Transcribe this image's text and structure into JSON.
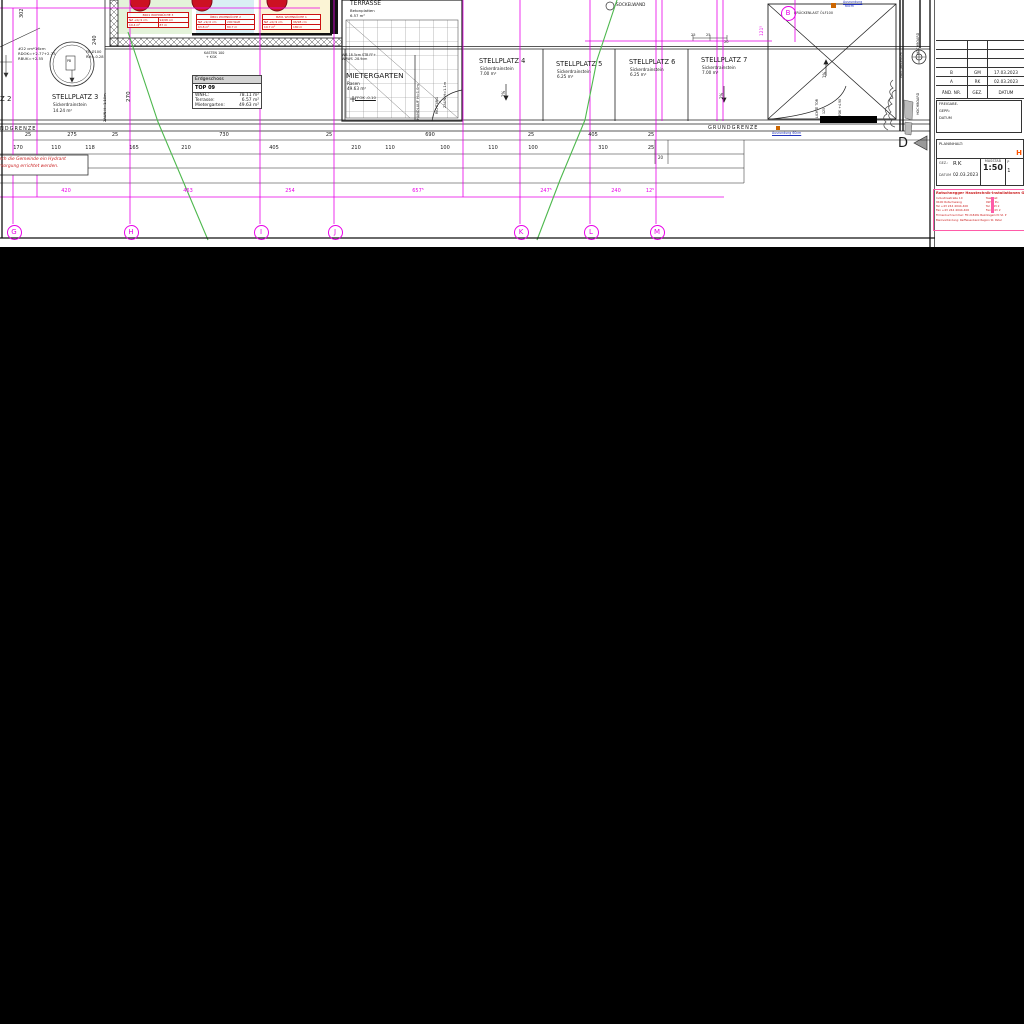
{
  "plan": {
    "colors": {
      "axis_magenta": "#e800e8",
      "contour_green": "#4db84d",
      "tag_red": "#cc1111",
      "note_red": "#cc2222",
      "blue_note": "#2233bb",
      "orange": "#cc6600",
      "room_green": "#e4f3da",
      "room_cyan": "#d9eff4",
      "room_yellow": "#fbf4d5"
    },
    "labels": [
      {
        "n": "stellplatz-2-label",
        "t": "Z 2",
        "x": 0,
        "y": 96,
        "s": 7
      },
      {
        "n": "stellplatz-3-label",
        "t": "STELLPLATZ 3",
        "x": 52,
        "y": 94,
        "s": 6.6
      },
      {
        "n": "stellplatz-3-sub",
        "t": "Sickerdrainstein",
        "x": 53,
        "y": 103,
        "s": 4.2
      },
      {
        "n": "stellplatz-3-area",
        "t": "14.24 m²",
        "x": 53,
        "y": 109,
        "s": 4.2
      },
      {
        "n": "shaft-note-1",
        "t": "#22 cm*16cm",
        "x": 18,
        "y": 47,
        "s": 3.8
      },
      {
        "n": "shaft-note-2",
        "t": "RDOK=+2.77+2.73",
        "x": 18,
        "y": 52,
        "s": 3.8
      },
      {
        "n": "shaft-note-3",
        "t": "RBUK=+2.55",
        "x": 18,
        "y": 57,
        "s": 3.8
      },
      {
        "n": "fb-note-1",
        "t": "FB Ø100",
        "x": 86,
        "y": 51,
        "s": 3.6
      },
      {
        "n": "fb-note-2",
        "t": "RH=-0.28",
        "x": 86,
        "y": 56,
        "s": 3.6
      },
      {
        "n": "dim-302",
        "t": "302",
        "x": 20,
        "y": 18,
        "s": 5,
        "r": 1
      },
      {
        "n": "dim-240",
        "t": "240",
        "x": 93,
        "y": 45,
        "s": 5,
        "r": 1
      },
      {
        "n": "dim-270",
        "t": "270",
        "x": 127,
        "y": 102,
        "s": 5.6,
        "r": 1
      },
      {
        "n": "zaun-left-label",
        "t": "ZAUN H=1.10m",
        "x": 104,
        "y": 122,
        "s": 3.6,
        "r": 1
      },
      {
        "n": "kasten-note-1",
        "t": "KASTEN 100",
        "x": 204,
        "y": 52,
        "s": 3.3
      },
      {
        "n": "kasten-note-2",
        "t": "+ KGK",
        "x": 206,
        "y": 56,
        "s": 3.3
      },
      {
        "n": "wb-note-1",
        "t": "WB 18.5cm STB FF+",
        "x": 342,
        "y": 54,
        "s": 3.3
      },
      {
        "n": "wb-note-2",
        "t": "WRWS -28.9cm",
        "x": 342,
        "y": 58,
        "s": 3.3
      },
      {
        "n": "terrasse-label",
        "t": "TERRASSE",
        "x": 350,
        "y": 1,
        "s": 6
      },
      {
        "n": "terrasse-material",
        "t": "Betonplatten",
        "x": 350,
        "y": 9,
        "s": 3.8
      },
      {
        "n": "terrasse-area",
        "t": "6.57 m²",
        "x": 350,
        "y": 14,
        "s": 3.8
      },
      {
        "n": "mietergarten-label",
        "t": "MIETERGARTEN",
        "x": 346,
        "y": 72,
        "s": 7.4
      },
      {
        "n": "mietergarten-surface",
        "t": "Rasen",
        "x": 347,
        "y": 82,
        "s": 4.2
      },
      {
        "n": "mietergarten-area",
        "t": "49.63 m²",
        "x": 347,
        "y": 87,
        "s": 4.2
      },
      {
        "n": "ffok-note",
        "t": "FFOK -0.10",
        "x": 355,
        "y": 96,
        "s": 3.8,
        "u": true
      },
      {
        "n": "handlauf-label",
        "t": "HANDLAUF H=1.0m",
        "x": 417,
        "y": 120,
        "s": 3.6,
        "r": 1
      },
      {
        "n": "zaun-right-label",
        "t": "ZAUN H=1.1m",
        "x": 444,
        "y": 108,
        "s": 3.6,
        "r": 1
      },
      {
        "n": "richtung-label",
        "t": "RICHTUNG",
        "x": 436,
        "y": 114,
        "s": 3.2,
        "r": 1
      },
      {
        "n": "stellplatz-4-label",
        "t": "STELLPLATZ 4",
        "x": 479,
        "y": 58,
        "s": 6.6
      },
      {
        "n": "stellplatz-4-sub",
        "t": "Sickerdrainstein",
        "x": 480,
        "y": 67,
        "s": 4.2
      },
      {
        "n": "stellplatz-4-area",
        "t": "7.00 m²",
        "x": 480,
        "y": 72,
        "s": 4.2
      },
      {
        "n": "stellplatz-5-label",
        "t": "STELLPLATZ 5",
        "x": 556,
        "y": 61,
        "s": 6.6
      },
      {
        "n": "stellplatz-5-sub",
        "t": "Sickerdrainstein",
        "x": 557,
        "y": 70,
        "s": 4.2
      },
      {
        "n": "stellplatz-5-area",
        "t": "6.25 m²",
        "x": 557,
        "y": 75,
        "s": 4.2
      },
      {
        "n": "stellplatz-6-label",
        "t": "STELLPLATZ 6",
        "x": 629,
        "y": 59,
        "s": 6.6
      },
      {
        "n": "stellplatz-6-sub",
        "t": "Sickerdrainstein",
        "x": 630,
        "y": 68,
        "s": 4.2
      },
      {
        "n": "stellplatz-6-area",
        "t": "6.25 m²",
        "x": 630,
        "y": 73,
        "s": 4.2
      },
      {
        "n": "stellplatz-7-label",
        "t": "STELLPLATZ 7",
        "x": 701,
        "y": 57,
        "s": 6.6
      },
      {
        "n": "stellplatz-7-sub",
        "t": "Sickerdrainstein",
        "x": 702,
        "y": 66,
        "s": 4.2
      },
      {
        "n": "stellplatz-7-area",
        "t": "7.00 m²",
        "x": 702,
        "y": 71,
        "s": 4.2
      },
      {
        "n": "slope-2pct-left",
        "t": "2%",
        "x": 502,
        "y": 97,
        "s": 4,
        "r": 1
      },
      {
        "n": "slope-2pct-right",
        "t": "2%",
        "x": 720,
        "y": 99,
        "s": 4,
        "r": 1
      },
      {
        "n": "sockelwand-label",
        "t": "SOCKELWAND",
        "x": 616,
        "y": 3,
        "s": 4.2
      },
      {
        "n": "dim-121-5",
        "t": "121⁵",
        "x": 761,
        "y": 36,
        "s": 4.4,
        "r": 1,
        "c": "#e800e8"
      },
      {
        "n": "bruckenlast-note",
        "t": "BRÜCKENLAST ÖLF100",
        "x": 794,
        "y": 12,
        "s": 3.4
      },
      {
        "n": "ausrundung-top-1",
        "t": "Ausrundung",
        "x": 843,
        "y": 1,
        "s": 3.2,
        "c": "#2233bb",
        "u": true
      },
      {
        "n": "ausrundung-top-2",
        "t": "60cm",
        "x": 845,
        "y": 5,
        "s": 3.2,
        "c": "#2233bb"
      },
      {
        "n": "slope-1pct",
        "t": "1%",
        "x": 823,
        "y": 78,
        "s": 4,
        "r": 1
      },
      {
        "n": "lichte-tor-label",
        "t": "LICHTE TOR",
        "x": 816,
        "y": 118,
        "s": 3.2,
        "r": 1
      },
      {
        "n": "tor-125",
        "t": "125",
        "x": 823,
        "y": 114,
        "s": 3.2,
        "r": 1
      },
      {
        "n": "ffok-tor",
        "t": "FFOK +4.90",
        "x": 839,
        "y": 118,
        "s": 3.2,
        "r": 1
      },
      {
        "n": "ausrundung-bottom",
        "t": "Ausrundung 60cm",
        "x": 772,
        "y": 132,
        "s": 3.2,
        "c": "#2233bb",
        "u": true
      },
      {
        "n": "grundgrenze-right",
        "t": "GRUNDGRENZE",
        "x": 708,
        "y": 126,
        "s": 5,
        "ls": 1
      },
      {
        "n": "grundgrenze-left",
        "t": "NDGRENZE",
        "x": 0,
        "y": 127,
        "s": 5,
        "ls": 1
      },
      {
        "n": "hydrant-note-1",
        "t": "durch die Gemeinde ein Hydrant",
        "x": -6,
        "y": 158,
        "s": 4.4,
        "c": "#cc2222",
        "i": true
      },
      {
        "n": "hydrant-note-2",
        "t": "versorgung errichtet werden.",
        "x": -6,
        "y": 165,
        "s": 4.4,
        "c": "#cc2222",
        "i": true
      },
      {
        "n": "mast-label",
        "t": "MAST/BELEUCHT.",
        "x": 900,
        "y": 78,
        "s": 3.2,
        "r": 1
      },
      {
        "n": "hochboard-label-1",
        "t": "HOCHBOARD",
        "x": 917,
        "y": 55,
        "s": 3.4,
        "r": 1
      },
      {
        "n": "hochboard-label-2",
        "t": "HOCHBOARD",
        "x": 917,
        "y": 115,
        "s": 3.4,
        "r": 1
      },
      {
        "n": "section-marker-d",
        "t": "D",
        "x": 898,
        "y": 137,
        "s": 13
      },
      {
        "n": "dim-25-a",
        "t": "25",
        "x": 691,
        "y": 34,
        "s": 3.6
      },
      {
        "n": "dim-25-b",
        "t": "25",
        "x": 706,
        "y": 34,
        "s": 3.6
      },
      {
        "n": "dim-20-a",
        "t": "20",
        "x": 724,
        "y": 41,
        "s": 3.6
      },
      {
        "n": "dim-20-b",
        "t": "20",
        "x": 658,
        "y": 156,
        "s": 4
      },
      {
        "n": "pb-label",
        "t": "PB",
        "x": 67,
        "y": 60,
        "s": 3.2
      }
    ],
    "dim_rows": [
      {
        "name": "dim-row-top",
        "y": 133,
        "s": 5,
        "c": "#1a1a1a",
        "items": [
          {
            "t": "25",
            "x": 28
          },
          {
            "t": "275",
            "x": 72
          },
          {
            "t": "25",
            "x": 115
          },
          {
            "t": "730",
            "x": 224
          },
          {
            "t": "25",
            "x": 329
          },
          {
            "t": "690",
            "x": 430
          },
          {
            "t": "25",
            "x": 531
          },
          {
            "t": "405",
            "x": 593
          },
          {
            "t": "25",
            "x": 651
          }
        ]
      },
      {
        "name": "dim-row-mid",
        "y": 146,
        "s": 5,
        "c": "#1a1a1a",
        "items": [
          {
            "t": "170",
            "x": 18
          },
          {
            "t": "110",
            "x": 56
          },
          {
            "t": "118",
            "x": 90
          },
          {
            "t": "165",
            "x": 134
          },
          {
            "t": "210",
            "x": 186
          },
          {
            "t": "405",
            "x": 274
          },
          {
            "t": "210",
            "x": 356
          },
          {
            "t": "110",
            "x": 390
          },
          {
            "t": "100",
            "x": 445
          },
          {
            "t": "110",
            "x": 493
          },
          {
            "t": "100",
            "x": 533
          },
          {
            "t": "310",
            "x": 603
          },
          {
            "t": "25",
            "x": 651
          }
        ]
      },
      {
        "name": "dim-row-magenta",
        "y": 189,
        "s": 5,
        "c": "#e800e8",
        "items": [
          {
            "t": "420",
            "x": 66
          },
          {
            "t": "463",
            "x": 188
          },
          {
            "t": "254",
            "x": 290
          },
          {
            "t": "657⁵",
            "x": 418
          },
          {
            "t": "247⁵",
            "x": 546
          },
          {
            "t": "240",
            "x": 616
          },
          {
            "t": "12⁵",
            "x": 650
          }
        ]
      }
    ],
    "grid_bubbles": [
      {
        "letter": "G",
        "x": 13,
        "y": 231
      },
      {
        "letter": "H",
        "x": 130,
        "y": 231
      },
      {
        "letter": "I",
        "x": 260,
        "y": 231
      },
      {
        "letter": "J",
        "x": 334,
        "y": 231
      },
      {
        "letter": "K",
        "x": 520,
        "y": 231
      },
      {
        "letter": "L",
        "x": 590,
        "y": 231
      },
      {
        "letter": "M",
        "x": 656,
        "y": 231
      },
      {
        "letter": "B",
        "x": 787,
        "y": 12
      }
    ],
    "room_tags": [
      {
        "x": 127,
        "y": 12,
        "w": 60,
        "header": "BK01 WOHNKÜCHE 3",
        "r2": [
          "NZ +0/-9 cm",
          "94/98 cm"
        ],
        "r3": [
          "19.4 m²",
          "87 m"
        ]
      },
      {
        "x": 196,
        "y": 14,
        "w": 57,
        "header": "ÖB01 WOHNKÜCHE 2",
        "r2": [
          "NZ +9/-0 cm",
          "200 Watt"
        ],
        "r3": [
          "63.8 m²",
          "80.7 m"
        ]
      },
      {
        "x": 262,
        "y": 14,
        "w": 57,
        "header": "BZ01 WOHNKÜCHE 1",
        "r2": [
          "NZ +0/-9 cm",
          "96/98 cm"
        ],
        "r3": [
          "19.7 m²",
          "180 m"
        ]
      }
    ],
    "eg_table": {
      "title": "Erdgeschoss",
      "name": "TOP 09",
      "rows": [
        [
          "WNFL:",
          "78.11 m²"
        ],
        [
          "Terrasse:",
          "6.57 m²"
        ],
        [
          "Mietergarten:",
          "49.63 m²"
        ]
      ]
    }
  },
  "title_block": {
    "revision": {
      "rows": [
        [
          "",
          "",
          ""
        ],
        [
          "",
          "",
          ""
        ],
        [
          "",
          "",
          ""
        ],
        [
          "B",
          "GM",
          "17.03.2023"
        ],
        [
          "A",
          "RK",
          "02.03.2023"
        ]
      ],
      "header": [
        "ÄND. NR.",
        "GEZ.",
        "DATUM"
      ]
    },
    "freigabe_lines": [
      "FREIGABE-",
      "GEPR:",
      "DATUM"
    ],
    "planinhalt": {
      "label": "PLANINHALT:",
      "title_fragment": "H",
      "gez_label": "GEZ.:",
      "gez_value": "RK",
      "datum_label": "DATUM",
      "datum_value": "02.03.2023",
      "masstab_label": "MASSTAB",
      "masstab_value": "1:50",
      "col3_top": "P",
      "col3_bottom": "1"
    },
    "company": {
      "line1": "Rotschnegger Haustechnik-Installationen Ge",
      "left": [
        "Industriestraße 10",
        "9100 Rotschwang",
        "Tel +43 244 4044-400",
        "Fax +43 244 4044-400"
      ],
      "right": [
        "Tewebst",
        "9W M Pu",
        "Tel +43 2",
        "Fax +43 2"
      ],
      "bottom": [
        "Firmenbuchnummer: FN 21848x  Bezirksgericht St. P",
        "Bankverbindung: Raiffeisenbank Region St. Peter"
      ]
    }
  }
}
